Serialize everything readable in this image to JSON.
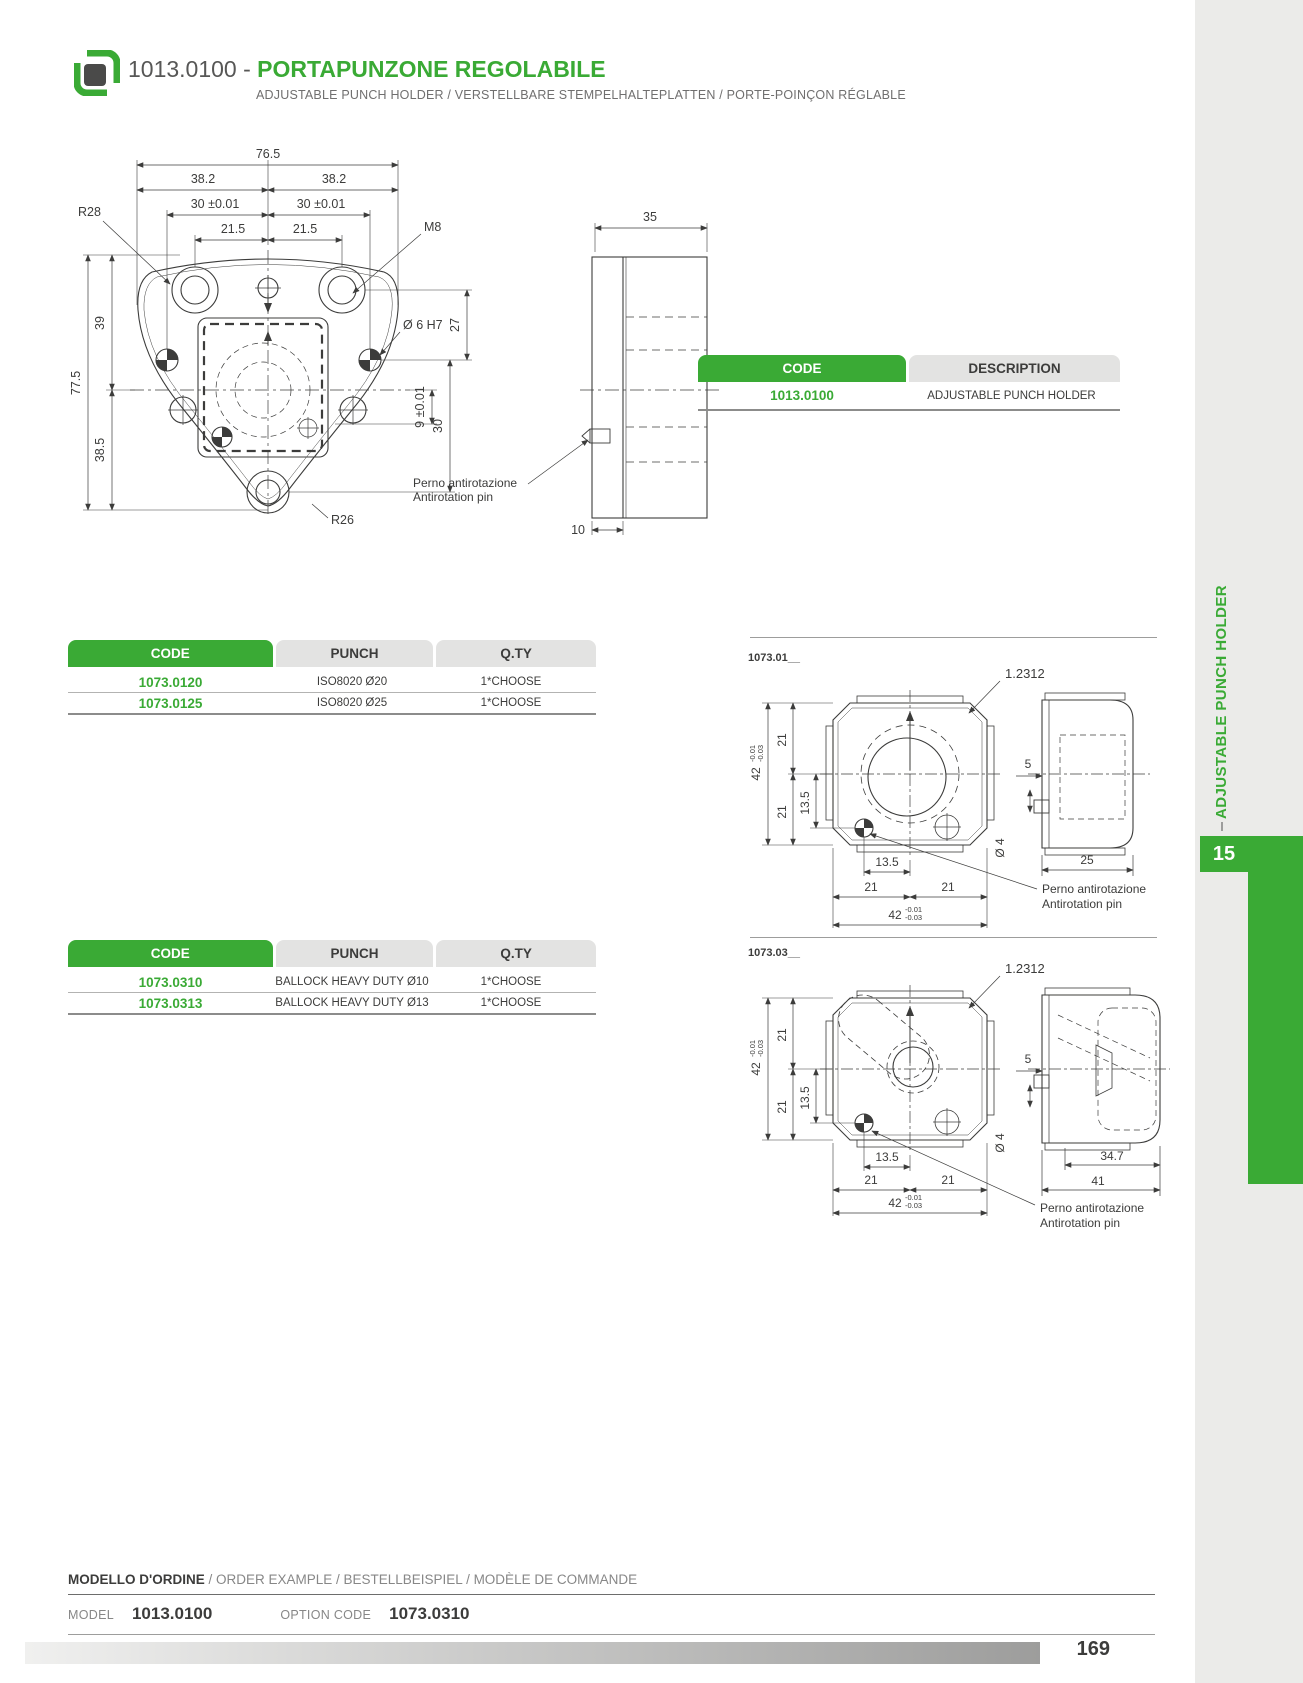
{
  "colors": {
    "green": "#3aaa35",
    "dark_text": "#3c3c3b",
    "gray_text": "#878787",
    "table_gray": "#e3e3e2",
    "strip_gray": "#ebebe9"
  },
  "header": {
    "code_prefix": "1013.0100 - ",
    "title": "PORTAPUNZONE REGOLABILE",
    "subtitle": "ADJUSTABLE PUNCH HOLDER / VERSTELLBARE STEMPELHALTEPLATTEN / PORTE-POINÇON RÉGLABLE",
    "icon": "punch-holder-icon"
  },
  "code_table": {
    "col_code": "CODE",
    "col_desc": "DESCRIPTION",
    "rows": [
      {
        "code": "1013.0100",
        "desc": "ADJUSTABLE PUNCH HOLDER"
      }
    ]
  },
  "punch_table_1": {
    "col_code": "CODE",
    "col_punch": "PUNCH",
    "col_qty": "Q.TY",
    "rows": [
      {
        "code": "1073.0120",
        "punch": "ISO8020 Ø20",
        "qty": "1*CHOOSE"
      },
      {
        "code": "1073.0125",
        "punch": "ISO8020 Ø25",
        "qty": "1*CHOOSE"
      }
    ]
  },
  "punch_table_2": {
    "col_code": "CODE",
    "col_punch": "PUNCH",
    "col_qty": "Q.TY",
    "rows": [
      {
        "code": "1073.0310",
        "punch": "BALLOCK HEAVY DUTY Ø10",
        "qty": "1*CHOOSE"
      },
      {
        "code": "1073.0313",
        "punch": "BALLOCK HEAVY DUTY Ø13",
        "qty": "1*CHOOSE"
      }
    ]
  },
  "dwg_main": {
    "d765": "76.5",
    "d382": "38.2",
    "d30t": "30 ±0.01",
    "d215": "21.5",
    "r28": "R28",
    "m8": "M8",
    "d6h7": "Ø 6 H7",
    "d27": "27",
    "d30": "30",
    "d9t": "9 ±0.01",
    "d39": "39",
    "d775": "77.5",
    "d385": "38.5",
    "r26": "R26",
    "d35": "35",
    "d10": "10",
    "note1": "Perno antirotazione",
    "note2": "Antirotation pin"
  },
  "dwg_01": {
    "id": "1073.01__",
    "material": "1.2312",
    "d42": "42",
    "tol_hi": "-0.01",
    "tol_lo": "-0.03",
    "d21": "21",
    "d135": "13.5",
    "d5": "5",
    "dia4": "Ø 4",
    "d25": "25",
    "note1": "Perno antirotazione",
    "note2": "Antirotation pin"
  },
  "dwg_03": {
    "id": "1073.03__",
    "material": "1.2312",
    "d42": "42",
    "tol_hi": "-0.01",
    "tol_lo": "-0.03",
    "d21": "21",
    "d135": "13.5",
    "d5": "5",
    "dia4": "Ø 4",
    "d347": "34.7",
    "d41": "41",
    "note1": "Perno antirotazione",
    "note2": "Antirotation pin"
  },
  "sidebar": {
    "vertical_label": "ADJUSTABLE PUNCH HOLDER",
    "chapter_tab": "15"
  },
  "footer": {
    "order_heading_main": "MODELLO D'ORDINE",
    "order_heading_rest": " / ORDER EXAMPLE / BESTELLBEISPIEL / MODÈLE DE COMMANDE",
    "model_label": "MODEL",
    "model_value": "1013.0100",
    "option_label": "OPTION CODE",
    "option_value": "1073.0310",
    "page_number": "169"
  }
}
